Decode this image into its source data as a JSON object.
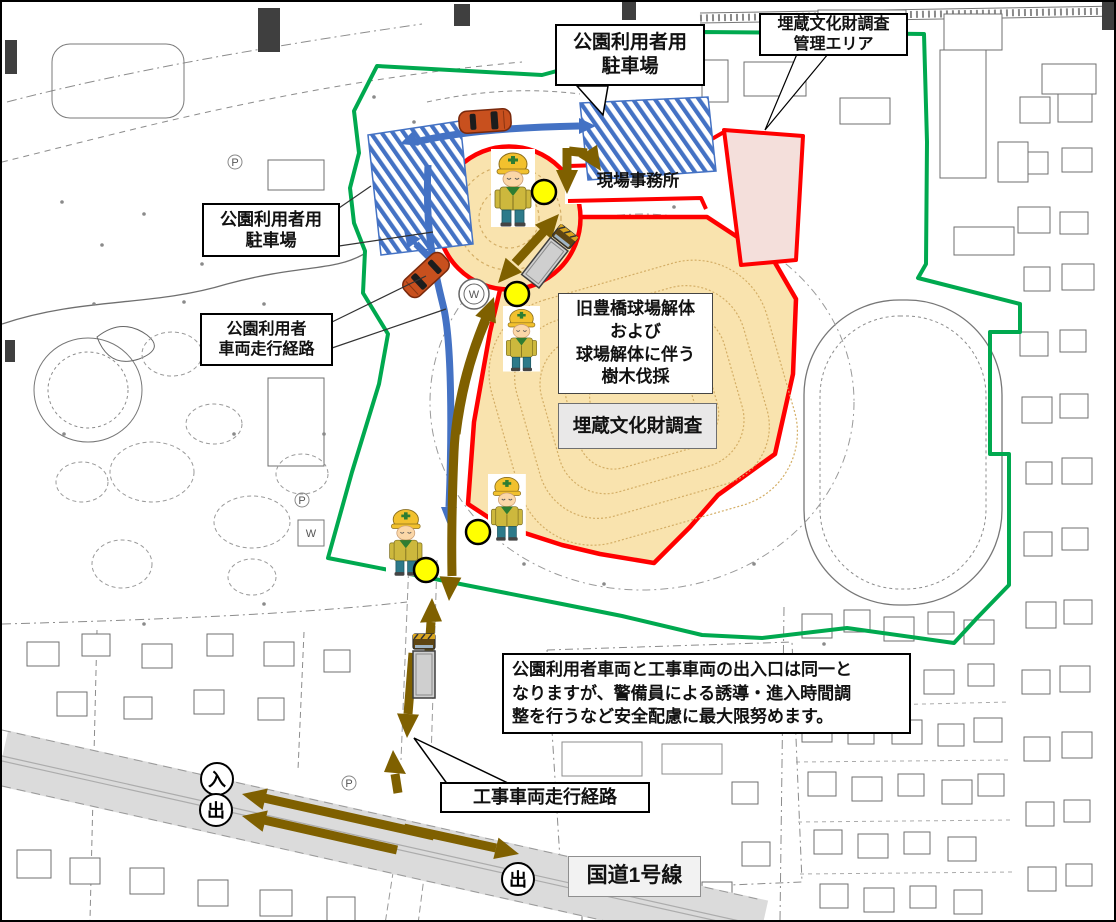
{
  "title": "site-traffic-route-map",
  "callout_parking_top": {
    "line1": "公園利用者用",
    "line2": "駐車場"
  },
  "callout_survey_area": {
    "line1": "埋蔵文化財調査",
    "line2": "管理エリア"
  },
  "site_office_label": "現場事務所",
  "label_parking_left": {
    "line1": "公園利用者用",
    "line2": "駐車場"
  },
  "label_visitor_route": {
    "line1": "公園利用者",
    "line2": "車両走行経路"
  },
  "box_demolition": {
    "line1": "旧豊橋球場解体",
    "line2": "および",
    "line3": "球場解体に伴う",
    "line4": "樹木伐採"
  },
  "box_survey": "埋蔵文化財調査",
  "note_box": {
    "line1": "公園利用者車両と工事車両の出入口は同一と",
    "line2": "なりますが、警備員による誘導・進入時間調",
    "line3": "整を行うなど安全配慮に最大限努めます。"
  },
  "callout_construction_route": "工事車両走行経路",
  "road_label": "国道1号線",
  "gate_markers": {
    "entry": "入",
    "exit": "出"
  },
  "map_symbols": {
    "water": "W",
    "parking": "P"
  },
  "colors": {
    "boundary_green": "#00A94F",
    "boundary_red": "#FF0000",
    "visitor_route_blue": "#4472C4",
    "construction_route_olive": "#7F6000",
    "stadium_area_beige": "#F9E3AE",
    "survey_area_pink": "#F4DFDB",
    "road_gray": "#DBDBDB",
    "checkpoint_yellow": "#FFFF00"
  }
}
